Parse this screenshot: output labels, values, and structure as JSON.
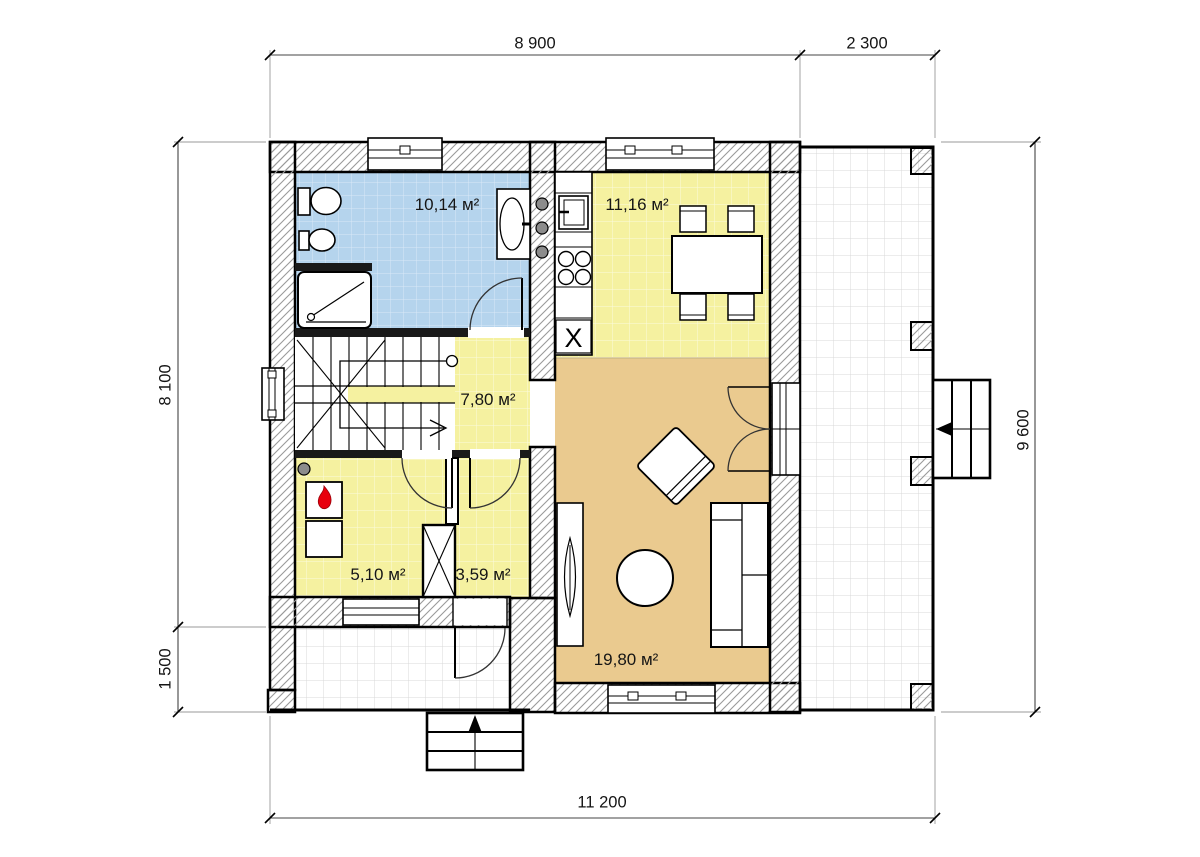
{
  "drawing": {
    "type": "house first floor plan",
    "units": "mm"
  },
  "rooms": [
    {
      "id": "bathroom",
      "area_label": "10,14 м²"
    },
    {
      "id": "kitchen",
      "area_label": "11,16 м²"
    },
    {
      "id": "hall",
      "area_label": "7,80 м²"
    },
    {
      "id": "boiler",
      "area_label": "5,10 м²"
    },
    {
      "id": "entry",
      "area_label": "3,59 м²"
    },
    {
      "id": "living",
      "area_label": "19,80 м²"
    }
  ],
  "dimensions": {
    "top_main": "8 900",
    "top_terrace": "2 300",
    "left_house": "8 100",
    "left_porch": "1 500",
    "right_total": "9 600",
    "bottom_total": "11 200"
  },
  "symbols": {
    "kitchen_sink": "X"
  },
  "colors": {
    "bathroom_floor": "#b5d4ed",
    "kitchen_hall_floor": "#f5f1a0",
    "living_floor": "#eaca8f",
    "terrace_grid": "#d9d9d9",
    "wall_hatch": "#9a9a9a",
    "flame_red": "#e8000d"
  }
}
